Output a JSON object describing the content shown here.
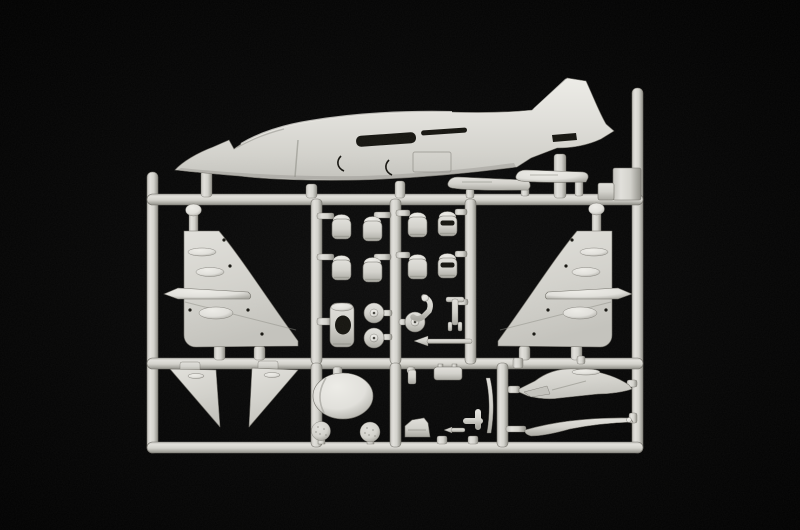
{
  "scene": {
    "description": "Photograph of a light grey injection-moulded plastic model kit sprue with Harrier jump-jet aircraft parts on a black studio background",
    "background_center": "#0c0c0c",
    "background_edge": "#000000"
  },
  "plastic": {
    "highlight": "#edece7",
    "light": "#e1e0db",
    "base": "#d3d2cc",
    "mid": "#c3c2bc",
    "dim": "#a9a8a1",
    "shadow": "#8e8d86",
    "edge": "#716f68",
    "recess": "#15140f"
  },
  "sprue": {
    "name": "model-kit-sprue",
    "frame_label": "rectangular sprue frame with runner rails",
    "parts": [
      {
        "id": "fuselage-half",
        "label": "aircraft fuselage half with tall tail fin"
      },
      {
        "id": "ventral-strakes",
        "label": "two ventral strake strips under rear fuselage"
      },
      {
        "id": "wing-panel-left",
        "label": "left wing panel with fairing bumps"
      },
      {
        "id": "aileron-left",
        "label": "left aileron strip with pointed tip"
      },
      {
        "id": "wing-panel-right",
        "label": "right wing panel with fairing bumps"
      },
      {
        "id": "aileron-right",
        "label": "right aileron strip with pointed tip"
      },
      {
        "id": "exhaust-nozzle",
        "label": "engine exhaust nozzle barrel"
      },
      {
        "id": "exhaust-nozzle-vented",
        "label": "front exhaust nozzle with vent slot"
      },
      {
        "id": "engine-cylinder",
        "label": "cylindrical engine part with opening"
      },
      {
        "id": "wheel",
        "label": "landing gear wheel"
      },
      {
        "id": "nose-gear-leg",
        "label": "curved nose landing gear leg"
      },
      {
        "id": "main-gear-leg",
        "label": "main landing gear strut with fork"
      },
      {
        "id": "pitot-probe",
        "label": "pointed pitot probe rod"
      },
      {
        "id": "tailplane-left",
        "label": "left anhedral tailplane wedge"
      },
      {
        "id": "tailplane-right",
        "label": "right anhedral tailplane wedge"
      },
      {
        "id": "canopy-shell",
        "label": "oval canopy shell"
      },
      {
        "id": "dimpled-ball",
        "label": "small dimpled sphere part"
      },
      {
        "id": "ejection-seat",
        "label": "ejection seat"
      },
      {
        "id": "equipment-box",
        "label": "small rectangular equipment box"
      },
      {
        "id": "antenna-blade",
        "label": "thin curved blade part"
      },
      {
        "id": "intake-lip-upper",
        "label": "upper intake lip fairing"
      },
      {
        "id": "intake-lip-lower",
        "label": "lower crescent intake lip"
      }
    ]
  }
}
